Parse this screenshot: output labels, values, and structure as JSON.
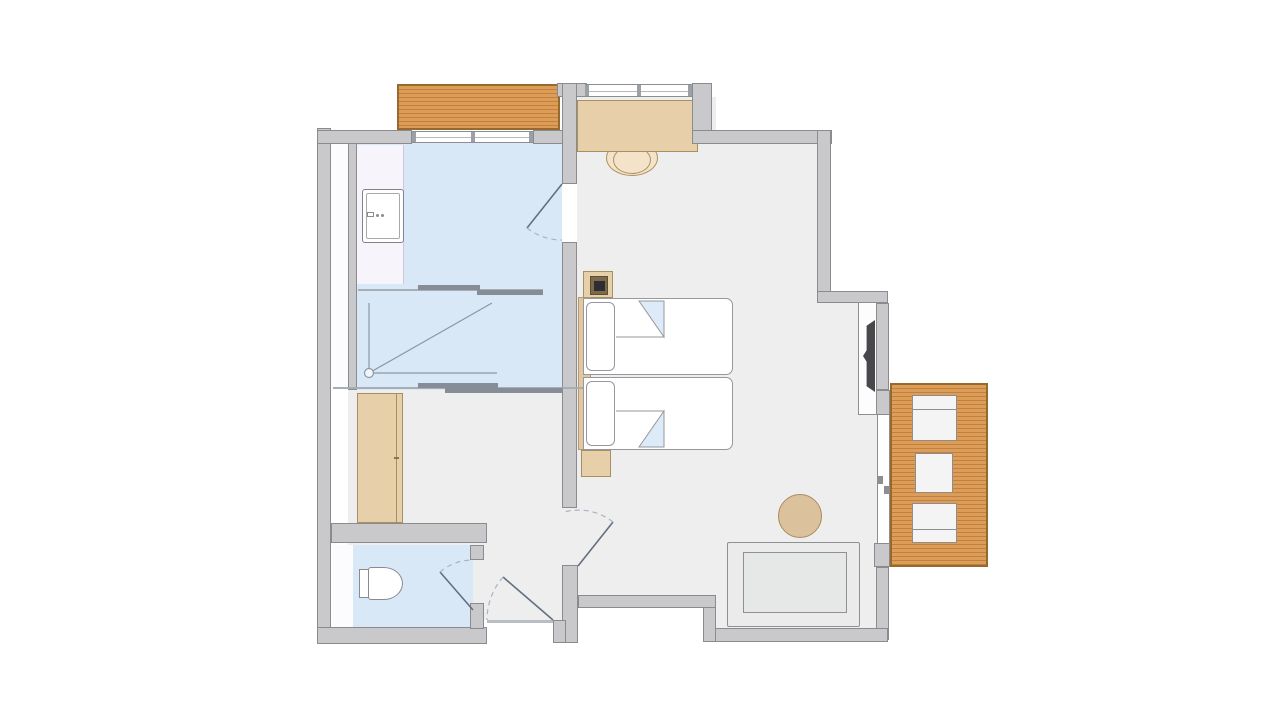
{
  "document": {
    "type": "architectural floor plan",
    "subject": "hotel twin room with bathroom, dressing area, WC and balcony",
    "visible_text": []
  },
  "palette": {
    "wall": "#c9c9cc",
    "walledge": "#8b8b8f",
    "floor": "#eeeeef",
    "bath": "#d9e8f7",
    "vanity": "#f7f4fb",
    "deck": "#dd9d57",
    "deckedge": "#96692f",
    "tan": "#e6cfa9",
    "tanedge": "#a59062",
    "outline": "#8d8d92",
    "fold": "#ddebf8",
    "tv": "#48484c",
    "door": "#63707e",
    "arc": "#a9b4c0",
    "sofa": "#ebebeb",
    "white": "#ffffff"
  },
  "rooms": [
    {
      "name": "bathroom",
      "floor": "#d9e8f7"
    },
    {
      "name": "dressing-hall",
      "floor": "#eeeeef"
    },
    {
      "name": "wc",
      "floor": "#d9e8f7"
    },
    {
      "name": "bedroom",
      "floor": "#eeeeef"
    },
    {
      "name": "balcony",
      "floor": "#dd9d57"
    }
  ],
  "elements": [
    {
      "name": "sink-vanity"
    },
    {
      "name": "shower"
    },
    {
      "name": "sliding-partition-upper"
    },
    {
      "name": "sliding-partition-lower"
    },
    {
      "name": "wardrobe"
    },
    {
      "name": "toilet"
    },
    {
      "name": "entry-door"
    },
    {
      "name": "wc-door"
    },
    {
      "name": "bathroom-door"
    },
    {
      "name": "hall-door"
    },
    {
      "name": "bathroom-window"
    },
    {
      "name": "bedroom-window"
    },
    {
      "name": "juliet-deck"
    },
    {
      "name": "desk"
    },
    {
      "name": "desk-chair"
    },
    {
      "name": "nightstand-top"
    },
    {
      "name": "bedside-lamp"
    },
    {
      "name": "headboard"
    },
    {
      "name": "twin-bed-1"
    },
    {
      "name": "twin-bed-2"
    },
    {
      "name": "pillow-1"
    },
    {
      "name": "pillow-2"
    },
    {
      "name": "nightstand-bottom"
    },
    {
      "name": "wall-tv"
    },
    {
      "name": "tv-panel"
    },
    {
      "name": "round-side-table"
    },
    {
      "name": "sofa-bench"
    },
    {
      "name": "balcony-sliding-door"
    },
    {
      "name": "balcony-deck"
    },
    {
      "name": "balcony-chair-1"
    },
    {
      "name": "balcony-table"
    },
    {
      "name": "balcony-chair-2"
    }
  ]
}
